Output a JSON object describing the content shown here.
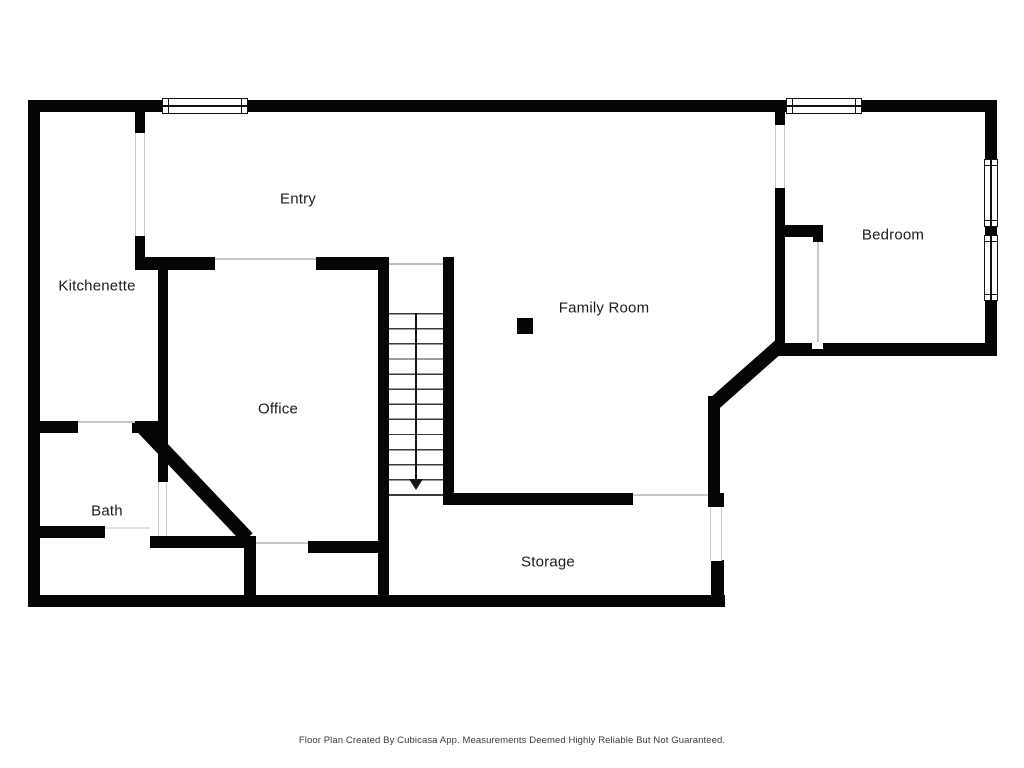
{
  "plan": {
    "source_note": "Floor Plan Created By Cubicasa App. Measurements Deemed Highly Reliable But Not Guaranteed."
  },
  "rooms": {
    "entry": {
      "label": "Entry"
    },
    "kitchenette": {
      "label": "Kitchenette"
    },
    "bedroom": {
      "label": "Bedroom"
    },
    "family_room": {
      "label": "Family Room"
    },
    "office": {
      "label": "Office"
    },
    "bath": {
      "label": "Bath"
    },
    "storage": {
      "label": "Storage"
    }
  },
  "stairs": {
    "direction": "down",
    "steps": 12,
    "icon": "arrow-down"
  },
  "symbols": {
    "column": "column-post",
    "windows_top_wall": 2,
    "windows_right_wall": 2
  },
  "colors": {
    "wall": "#050505",
    "opening_line": "#c9c9c9",
    "stair_tread": "#3a3a3a",
    "label_text": "#1b1b1b",
    "background": "#ffffff"
  }
}
